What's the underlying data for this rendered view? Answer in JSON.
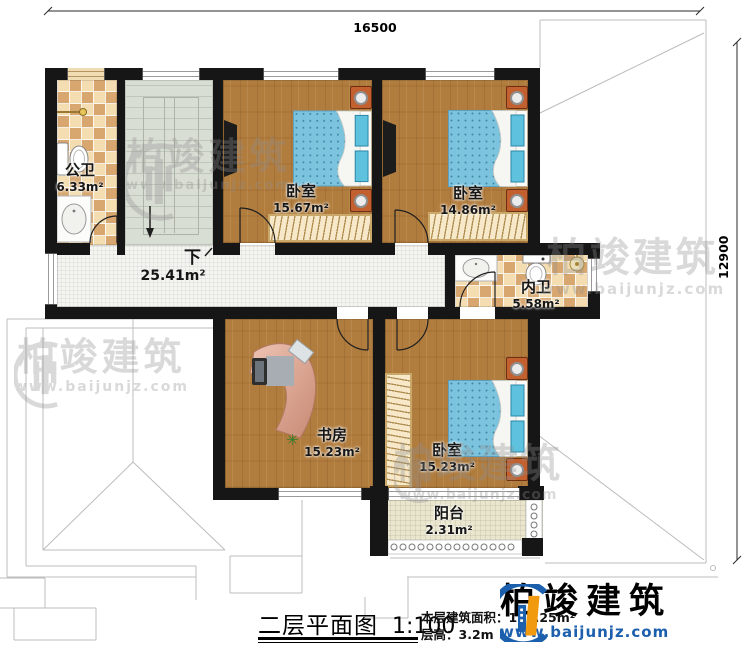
{
  "dimensions": {
    "width_mm": "16500",
    "depth_mm": "12900"
  },
  "rooms": {
    "gongwei": {
      "name": "公卫",
      "area": "6.33m²"
    },
    "bedroom1": {
      "name": "卧室",
      "area": "15.67m²"
    },
    "bedroom2": {
      "name": "卧室",
      "area": "14.86m²"
    },
    "neiwei": {
      "name": "内卫",
      "area": "5.58m²"
    },
    "corridor": {
      "area": "25.41m²",
      "stairs_label": "下"
    },
    "study": {
      "name": "书房",
      "area": "15.23m²"
    },
    "bedroom3": {
      "name": "卧室",
      "area": "15.23m²"
    },
    "balcony": {
      "name": "阳台",
      "area": "2.31m²"
    }
  },
  "title_block": {
    "title": "二层平面图",
    "scale": "1:100",
    "floor_area_label": "本层建筑面积：",
    "floor_area_value": "121.25m²",
    "floor_height_label": "层高：",
    "floor_height_value": "3.2m"
  },
  "brand": {
    "name": "柏竣建筑",
    "url": "www.baijunjz.com"
  },
  "watermark": {
    "name": "柏竣建筑",
    "url": "www.baijunjz.com"
  },
  "colors": {
    "wall": "#161616",
    "wood": "#b17d3f",
    "tile_light": "#f4ddb0",
    "tile_dark": "#d8a76f",
    "stair": "#d9ded4",
    "corridor": "#f4f4f1",
    "balcony_floor": "#eae6cd",
    "bed_blue": "#7cc4de",
    "pillow_cyan": "#5ec1de",
    "nightstand": "#c2602f",
    "desk": "#dba394",
    "brand_blue": "#1c5fad",
    "brand_orange": "#f29a0f"
  }
}
